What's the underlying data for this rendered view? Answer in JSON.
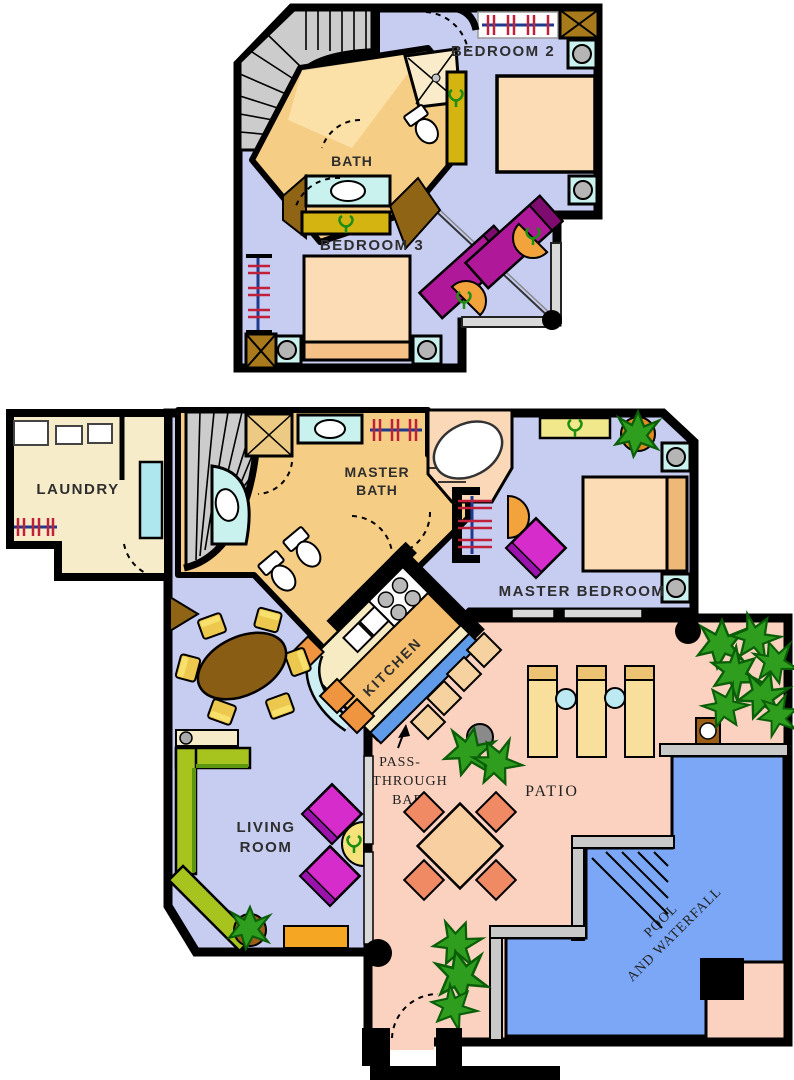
{
  "plan_title": "Two-story condo floor plan",
  "upper_floor": {
    "bedroom2_label": "BEDROOM 2",
    "bath_label": "BATH",
    "bedroom3_label": "BEDROOM 3"
  },
  "lower_floor": {
    "laundry_label": "LAUNDRY",
    "master_bath_line1": "MASTER",
    "master_bath_line2": "BATH",
    "master_bedroom_label": "MASTER BEDROOM",
    "kitchen_label": "KITCHEN",
    "pass_through_line1": "PASS-",
    "pass_through_line2": "THROUGH",
    "pass_through_line3": "BAR",
    "living_room_line1": "LIVING",
    "living_room_line2": "ROOM",
    "patio_label": "PATIO",
    "pool_line1": "POOL",
    "pool_line2": "AND WATERFALL"
  },
  "palette": {
    "wall": "#000000",
    "floor_lavender": "#c7ccf1",
    "bath_tan": "#f6cd84",
    "laundry_cream": "#f7ecca",
    "patio_salmon": "#fbd2c0",
    "pool_blue": "#7ba7f6",
    "bar_blue": "#5f9be8",
    "stairs_gray": "#cccccc",
    "bed_peach": "#fbdcb4",
    "counter_cyan": "#c9f2ee",
    "dresser_olive": "#d4b411",
    "magenta_furniture": "#d62ccc",
    "twinbed_magenta": "#b0189a",
    "sofa_green": "#a6c31e",
    "chair_orange": "#f2a33c",
    "plant_green": "#2f9e1f",
    "closet_rod_blue": "#1d3a8f",
    "hanger_red": "#c0203a"
  }
}
